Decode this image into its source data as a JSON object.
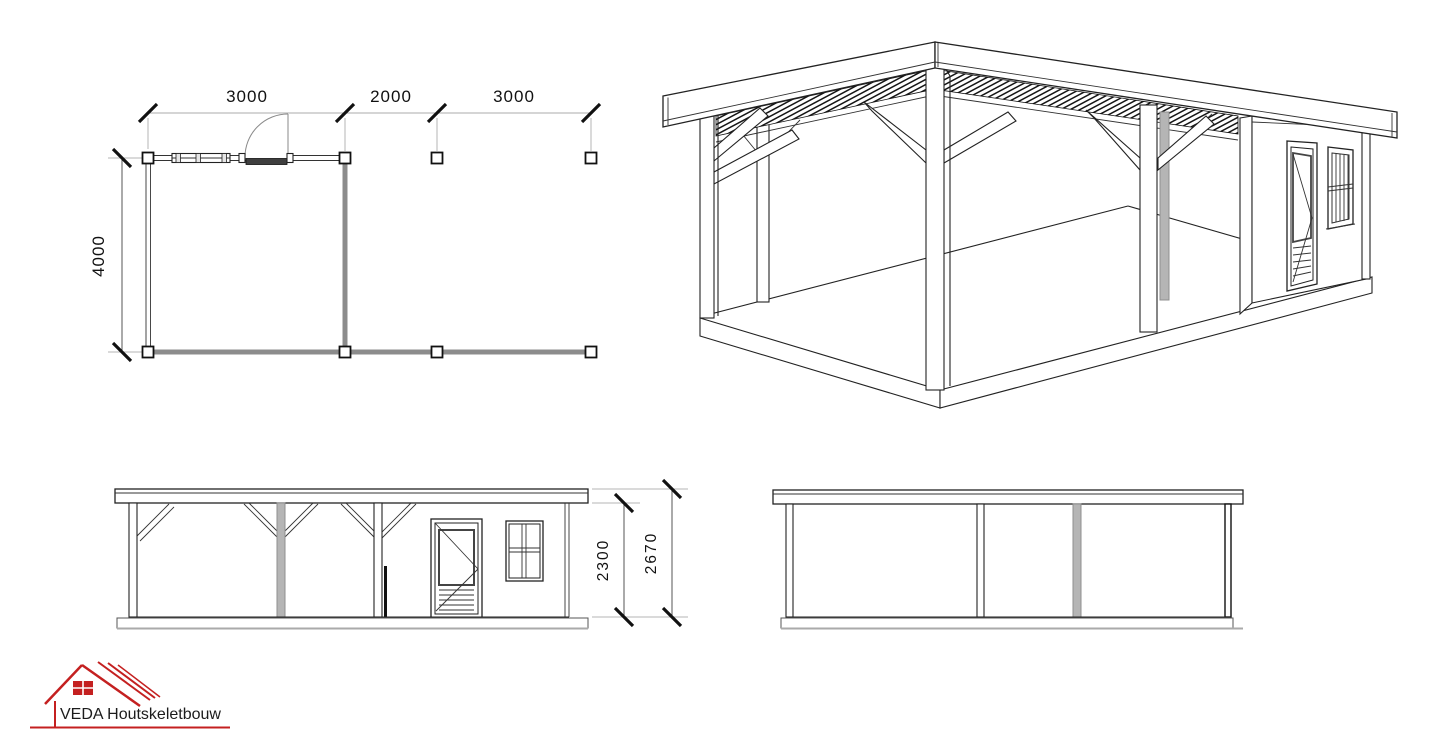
{
  "document": {
    "type": "timber-frame construction drawing",
    "background": "#ffffff"
  },
  "floor_plan": {
    "dim_bay_1": "3000",
    "dim_bay_2": "2000",
    "dim_bay_3": "3000",
    "dim_depth": "4000"
  },
  "front_elevation": {
    "dim_clear_height": "2300",
    "dim_total_height": "2670"
  },
  "logo": {
    "text": "VEDA Houtskeletbouw",
    "accent_color": "#c42020"
  },
  "colors": {
    "line": "#222222",
    "wall_gray": "#8c8c8c",
    "post_gray": "#b5b5b5",
    "dimension_gray": "#ababab",
    "logo_red": "#c42020"
  }
}
